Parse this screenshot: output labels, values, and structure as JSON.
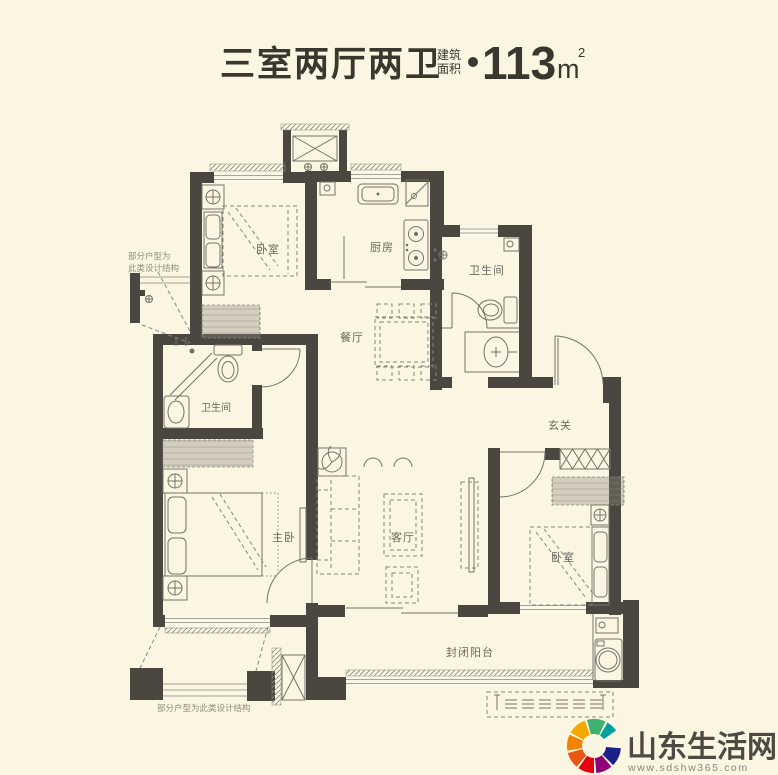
{
  "header": {
    "title": "三室两厅两卫",
    "area_label_top": "建筑",
    "area_label_bottom": "面积",
    "area_value": "113",
    "area_unit": "m",
    "area_unit_exp": "2"
  },
  "rooms": {
    "bedroom_top_left": "卧室",
    "kitchen": "厨房",
    "bathroom_top_right": "卫生间",
    "dining": "餐厅",
    "bathroom_left": "卫生间",
    "foyer": "玄关",
    "master_bedroom": "主卧",
    "living_room": "客厅",
    "bedroom_right": "卧室",
    "balcony": "封闭阳台"
  },
  "annotations": {
    "left_note_line1": "部分户型为",
    "left_note_line2": "此类设计结构",
    "bottom_note": "部分户型为此类设计结构"
  },
  "footer": {
    "site_name": "山东生活网",
    "site_url": "www.sdshw365.com",
    "logo_colors": [
      "#F5A800",
      "#3EB370",
      "#00A0A0",
      "#1D2088",
      "#8F0078",
      "#E60012",
      "#EA5514",
      "#F08300"
    ]
  },
  "colors": {
    "background": "#FAF6E1",
    "wall": "#4A4741",
    "furniture_line": "#75716A",
    "dash_line": "#8A867C",
    "title_text": "#3A372F",
    "room_label": "#6B675E",
    "annotation": "#908C80",
    "logo_text": "#4D4A44",
    "url_text": "#8A867C"
  }
}
